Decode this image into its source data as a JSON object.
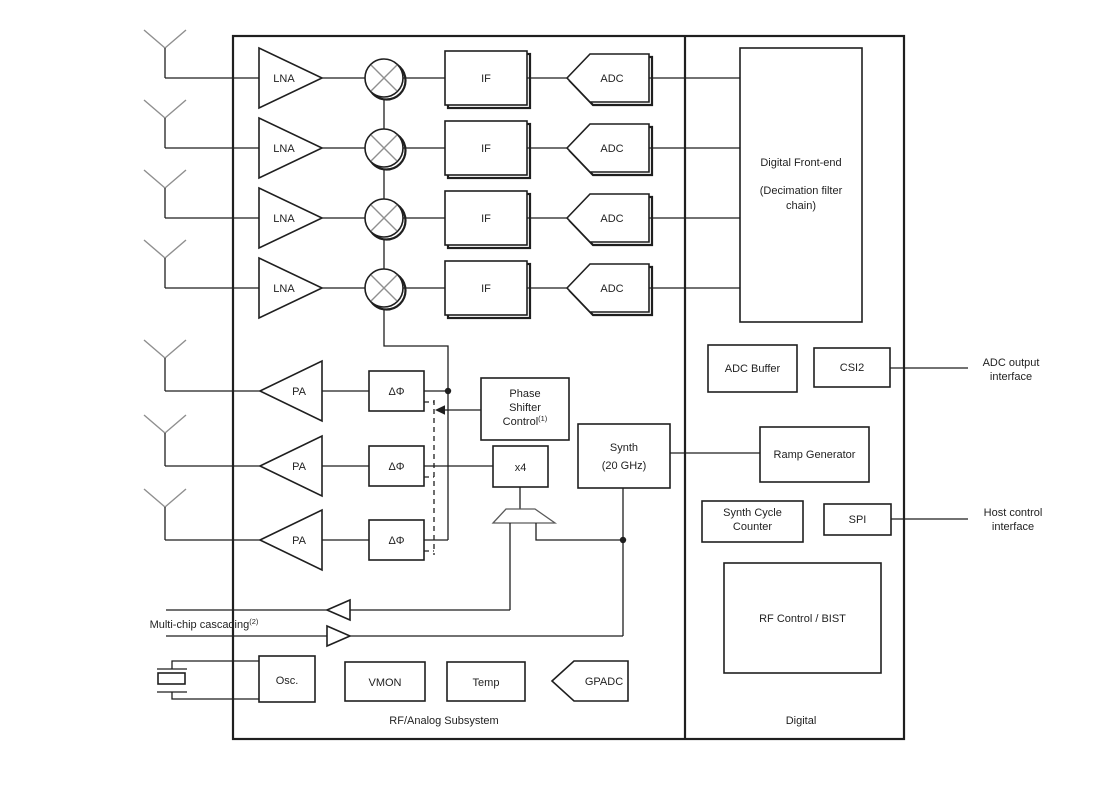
{
  "colors": {
    "line": "#1f1f1f",
    "muted": "#8f8f8f",
    "background": "#ffffff"
  },
  "labels": {
    "lna": "LNA",
    "if_block": "IF",
    "adc": "ADC",
    "pa": "PA",
    "phase_shifter": "ΔΦ",
    "phase_shifter_control": [
      "Phase",
      "Shifter",
      "Control"
    ],
    "phase_shifter_control_sup": "(1)",
    "multiplier": "x4",
    "synth": [
      "Synth",
      "(20 GHz)"
    ],
    "digital_front_end": [
      "Digital Front-end",
      "(Decimation filter",
      "chain)"
    ],
    "adc_buffer": "ADC Buffer",
    "csi2": "CSI2",
    "ramp_generator": "Ramp Generator",
    "synth_cycle_counter": [
      "Synth Cycle",
      "Counter"
    ],
    "spi": "SPI",
    "rf_control_bist": "RF Control / BIST",
    "osc": "Osc.",
    "vmon": "VMON",
    "temp": "Temp",
    "gpadc": "GPADC",
    "rf_analog_subsystem": "RF/Analog Subsystem",
    "digital": "Digital",
    "multi_chip_cascading": "Multi-chip cascading",
    "multi_chip_cascading_sup": "(2)",
    "adc_output_interface": [
      "ADC output",
      "interface"
    ],
    "host_control_interface": [
      "Host control",
      "interface"
    ]
  }
}
